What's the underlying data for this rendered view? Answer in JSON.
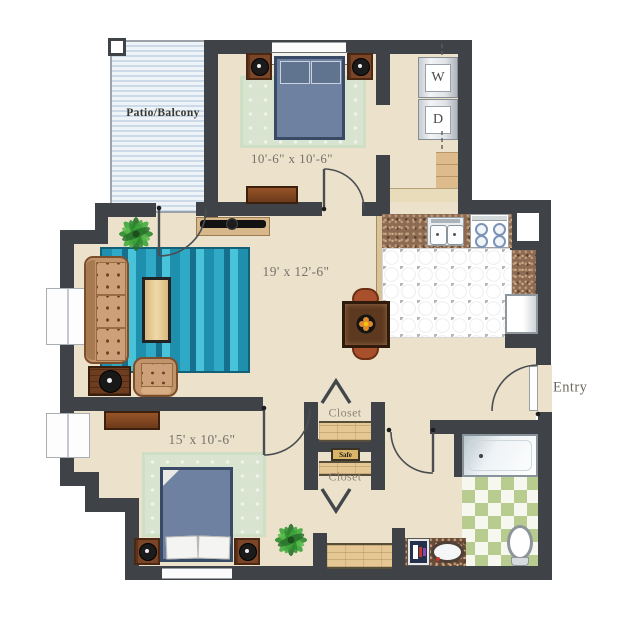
{
  "labels": {
    "patio": "Patio/Balcony",
    "bedroom1_dimensions": "10'-6\" x 10'-6\"",
    "living_dimensions": "19' x 12'-6\"",
    "bedroom2_dimensions": "15' x 10'-6\"",
    "closet_top": "Closet",
    "closet_bottom": "Closet",
    "safe": "Safe",
    "entry": "Entry",
    "washer": "W",
    "dryer": "D"
  },
  "colors": {
    "wall": "#3f4247",
    "floor": "#ece2cb",
    "teal_rug": "#2aa2c2",
    "sage_rug": "#d8e4cf",
    "bed": "#6e81a0",
    "wood": "#7b4527",
    "bath_tile_green": "#b9cc8f",
    "patio_stripe": "#ccd9e8"
  }
}
